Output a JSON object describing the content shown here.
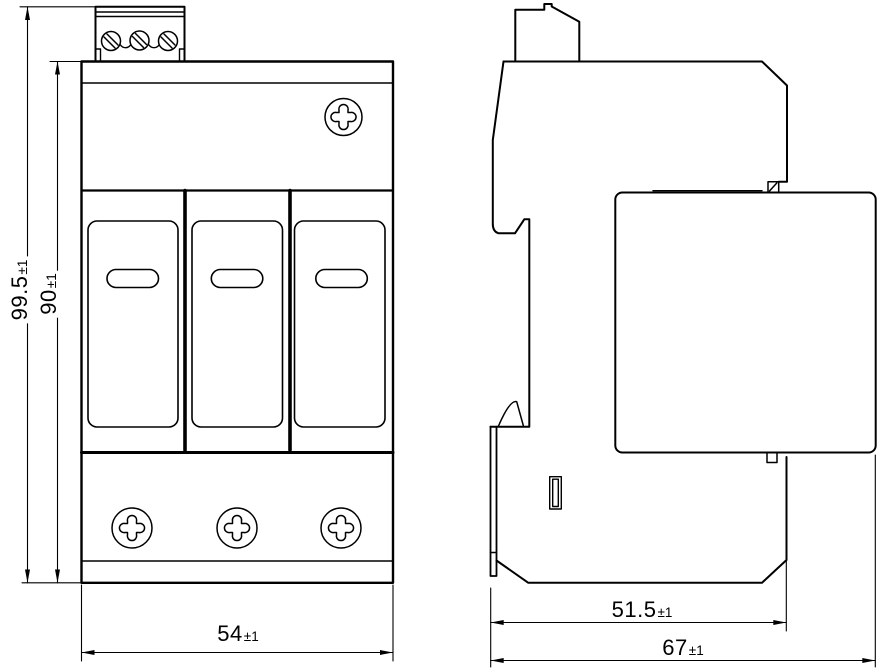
{
  "drawing": {
    "colors": {
      "line": "#000000",
      "background": "#ffffff"
    },
    "dimensions": {
      "overall_height": {
        "value": "99.5",
        "tolerance": "±1"
      },
      "body_height": {
        "value": "90",
        "tolerance": "±1"
      },
      "width": {
        "value": "54",
        "tolerance": "±1"
      },
      "body_depth": {
        "value": "51.5",
        "tolerance": "±1"
      },
      "overall_depth": {
        "value": "67",
        "tolerance": "±1"
      }
    }
  }
}
